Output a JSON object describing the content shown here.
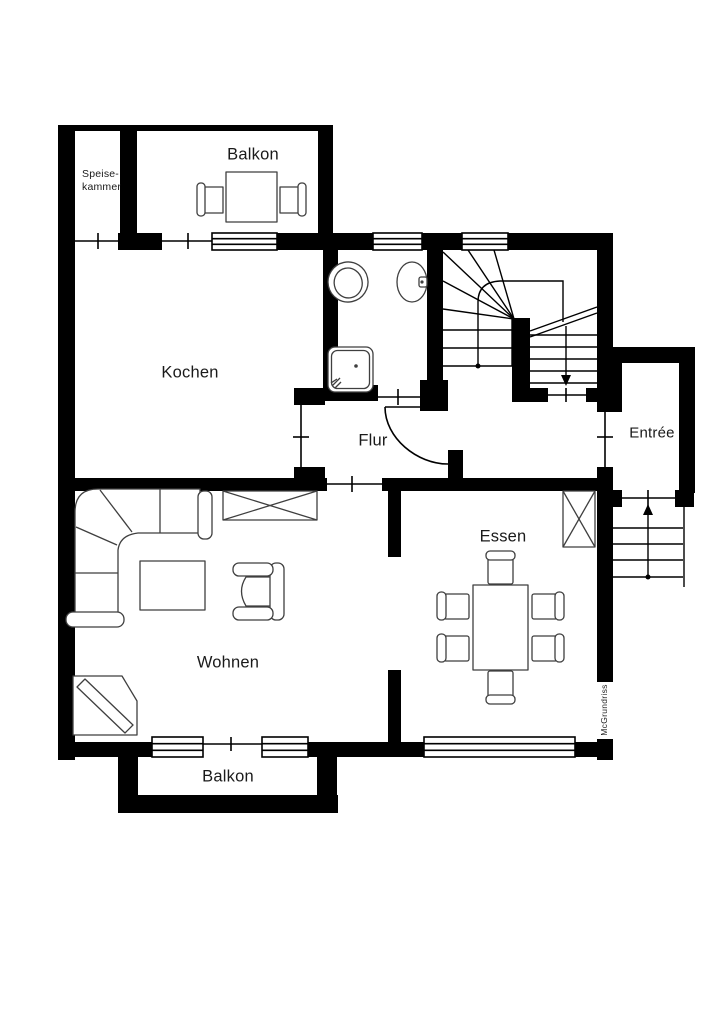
{
  "floorplan": {
    "watermark": "McGrundriss",
    "colors": {
      "walls": "#000000",
      "furniture_outline": "#3f3f3f",
      "background": "#ffffff",
      "text": "#1a1a1a"
    },
    "rooms": {
      "balkon_top": "Balkon",
      "speisekammer": {
        "line1": "Speise-",
        "line2": "kammer"
      },
      "kochen": "Kochen",
      "flur": "Flur",
      "entree": "Entrée",
      "wohnen": "Wohnen",
      "essen": "Essen",
      "balkon_bottom": "Balkon"
    }
  }
}
